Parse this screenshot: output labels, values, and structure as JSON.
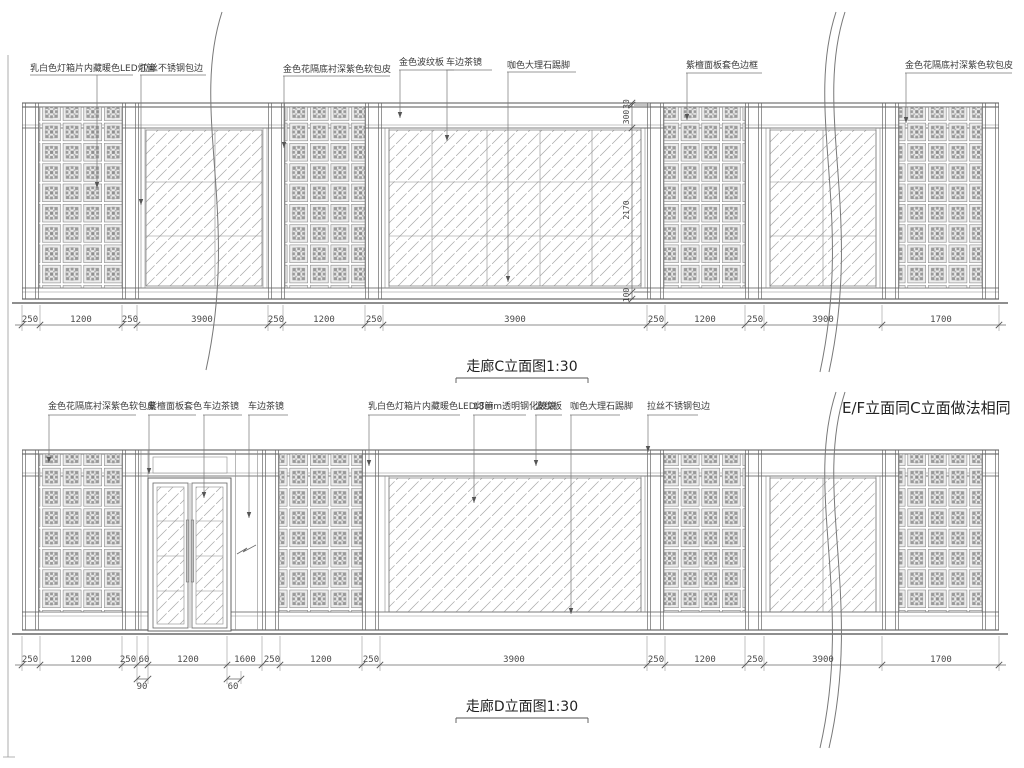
{
  "drawing": {
    "titles": {
      "elevation_c": "走廊C立面图1:30",
      "elevation_d": "走廊D立面图1:30"
    },
    "note": {
      "ef_same_as_c": "E/F立面同C立面做法相同"
    },
    "callouts_top": [
      "乳白色灯箱片内藏暖色LED灯管",
      "拉丝不锈钢包边",
      "金色花隔底衬深紫色软包皮",
      "金色波纹板",
      "车边茶镜",
      "咖色大理石踢脚",
      "紫檀面板套色边框",
      "金色花隔底衬深紫色软包皮"
    ],
    "callouts_bottom": [
      "金色花隔底衬深紫色软包皮",
      "紫檀面板套色",
      "车边茶镜",
      "车边茶镜",
      "乳白色灯箱片内藏暖色LED灯管",
      "18mm透明钢化玻璃",
      "波纹板",
      "咖色大理石踢脚",
      "拉丝不锈钢包边"
    ],
    "dims_top": [
      "250",
      "1200",
      "250",
      "3900",
      "250",
      "1200",
      "250",
      "3900",
      "250",
      "1200",
      "250",
      "3900",
      "1700"
    ],
    "dims_bottom": [
      "250",
      "1200",
      "250",
      "60",
      "1200",
      "1600",
      "250",
      "1200",
      "250",
      "3900",
      "250",
      "1200",
      "250",
      "3900",
      "1700"
    ],
    "dims_bottom_sub": [
      "90",
      "60"
    ],
    "dims_vertical": [
      "30",
      "300",
      "2170",
      "100"
    ],
    "colors": {
      "line": "#4a4a4a",
      "line_light": "#9a9a9a",
      "text": "#333333",
      "background": "#ffffff"
    }
  }
}
